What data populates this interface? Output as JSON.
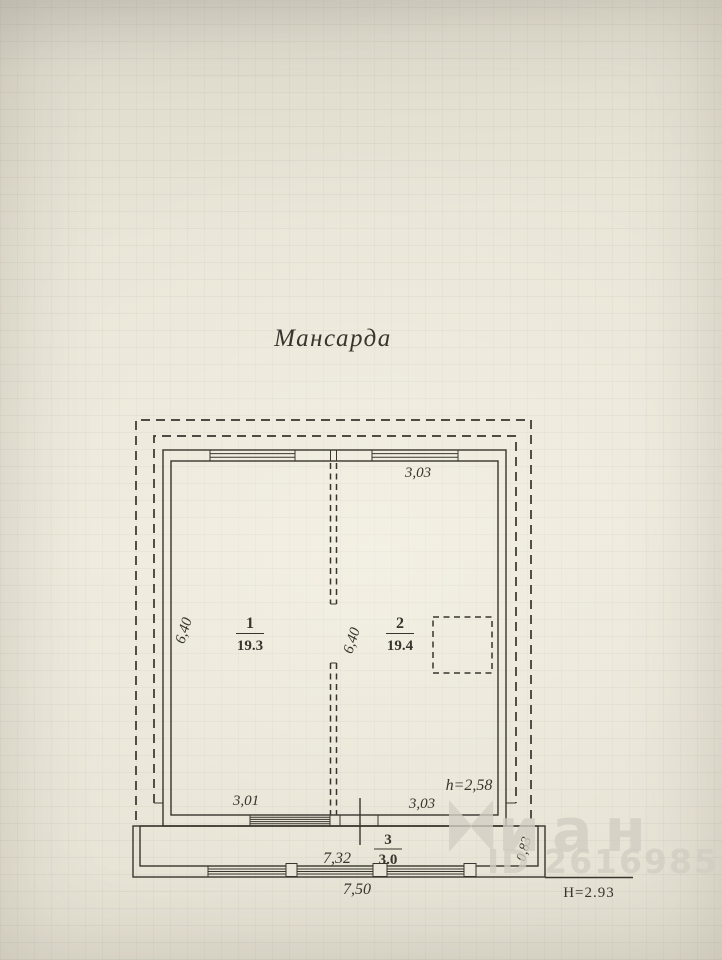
{
  "title": "Мансарда",
  "rooms": [
    {
      "number": "1",
      "area": "19.3"
    },
    {
      "number": "2",
      "area": "19.4"
    },
    {
      "number": "3",
      "area": "3.0"
    }
  ],
  "dimensions": {
    "top_width": "3,03",
    "left_depth": "6,40",
    "center_depth": "6,40",
    "room1_width": "3,01",
    "room2_width": "3,03",
    "inner_height": "h=2,58",
    "balcony_inner_width": "7,32",
    "balcony_depth": "0,83",
    "overall_width": "7,50",
    "overall_height": "H=2.93"
  },
  "watermark": {
    "brand_text": "иан",
    "id_text": "ID 2616985"
  },
  "colors": {
    "paper": "#eae6d9",
    "ink": "#39352e",
    "watermark": "#d2cec3"
  }
}
